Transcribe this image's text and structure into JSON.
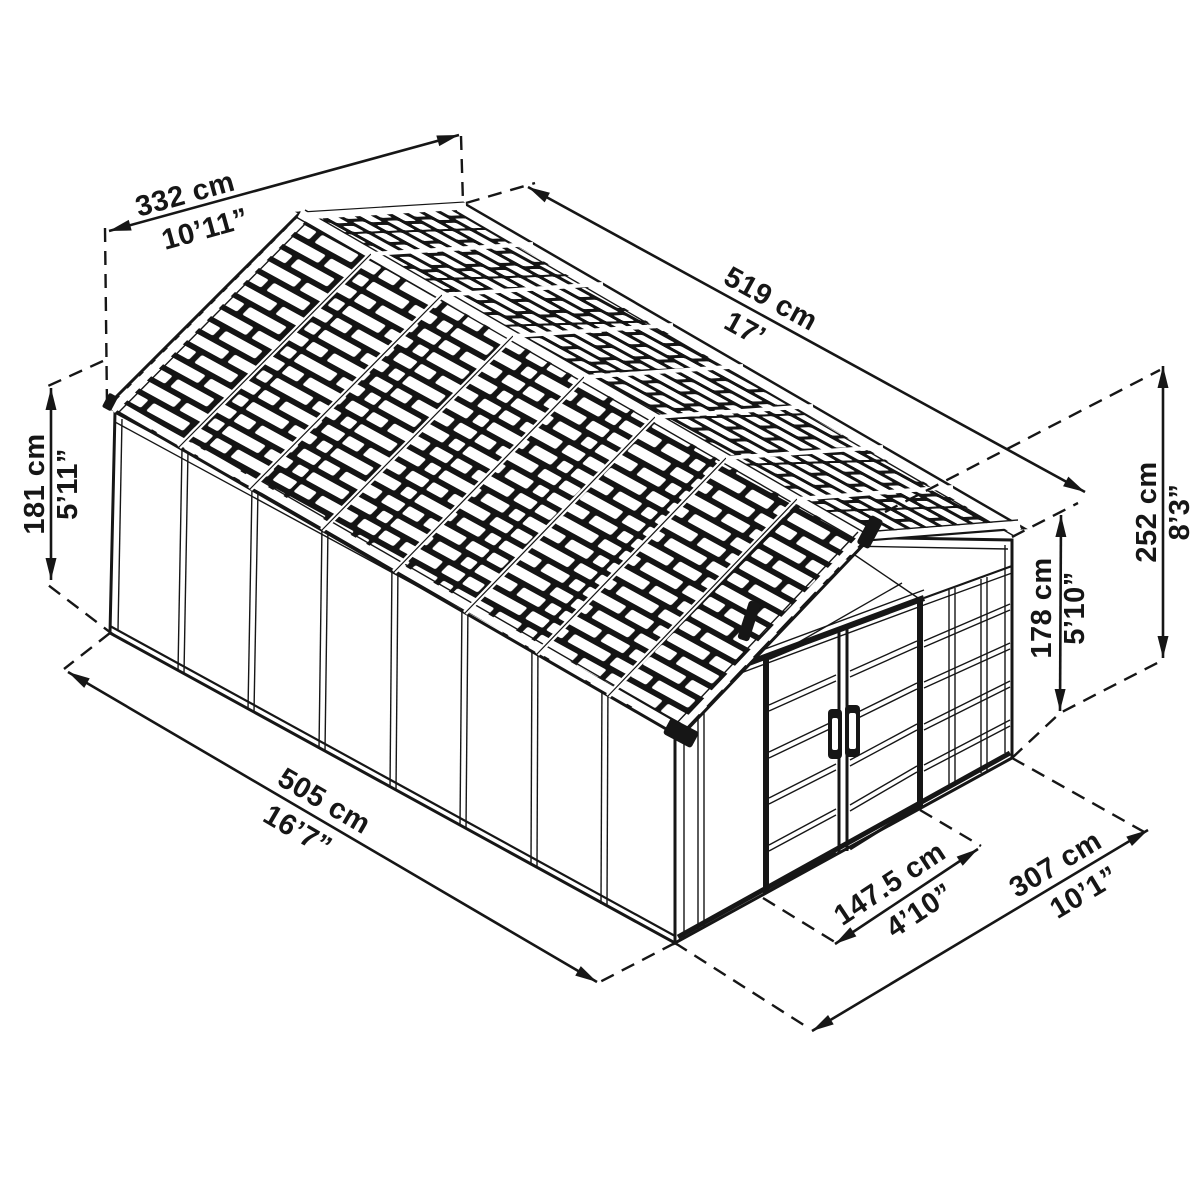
{
  "diagram": {
    "title": "Shed isometric dimension drawing",
    "colors": {
      "line": "#161616",
      "background": "#ffffff",
      "roof_dark": "#141414"
    },
    "dimensions": {
      "roof_width": {
        "cm": "332 cm",
        "imperial": "10’11”"
      },
      "roof_length": {
        "cm": "519 cm",
        "imperial": "17’"
      },
      "wall_height": {
        "cm": "181 cm",
        "imperial": "5’11”"
      },
      "total_height": {
        "cm": "252 cm",
        "imperial": "8’3”"
      },
      "door_height": {
        "cm": "178 cm",
        "imperial": "5’10”"
      },
      "base_length": {
        "cm": "505 cm",
        "imperial": "16’7”"
      },
      "door_width": {
        "cm": "147.5 cm",
        "imperial": "4’10”"
      },
      "base_width": {
        "cm": "307 cm",
        "imperial": "10’1”"
      }
    }
  }
}
